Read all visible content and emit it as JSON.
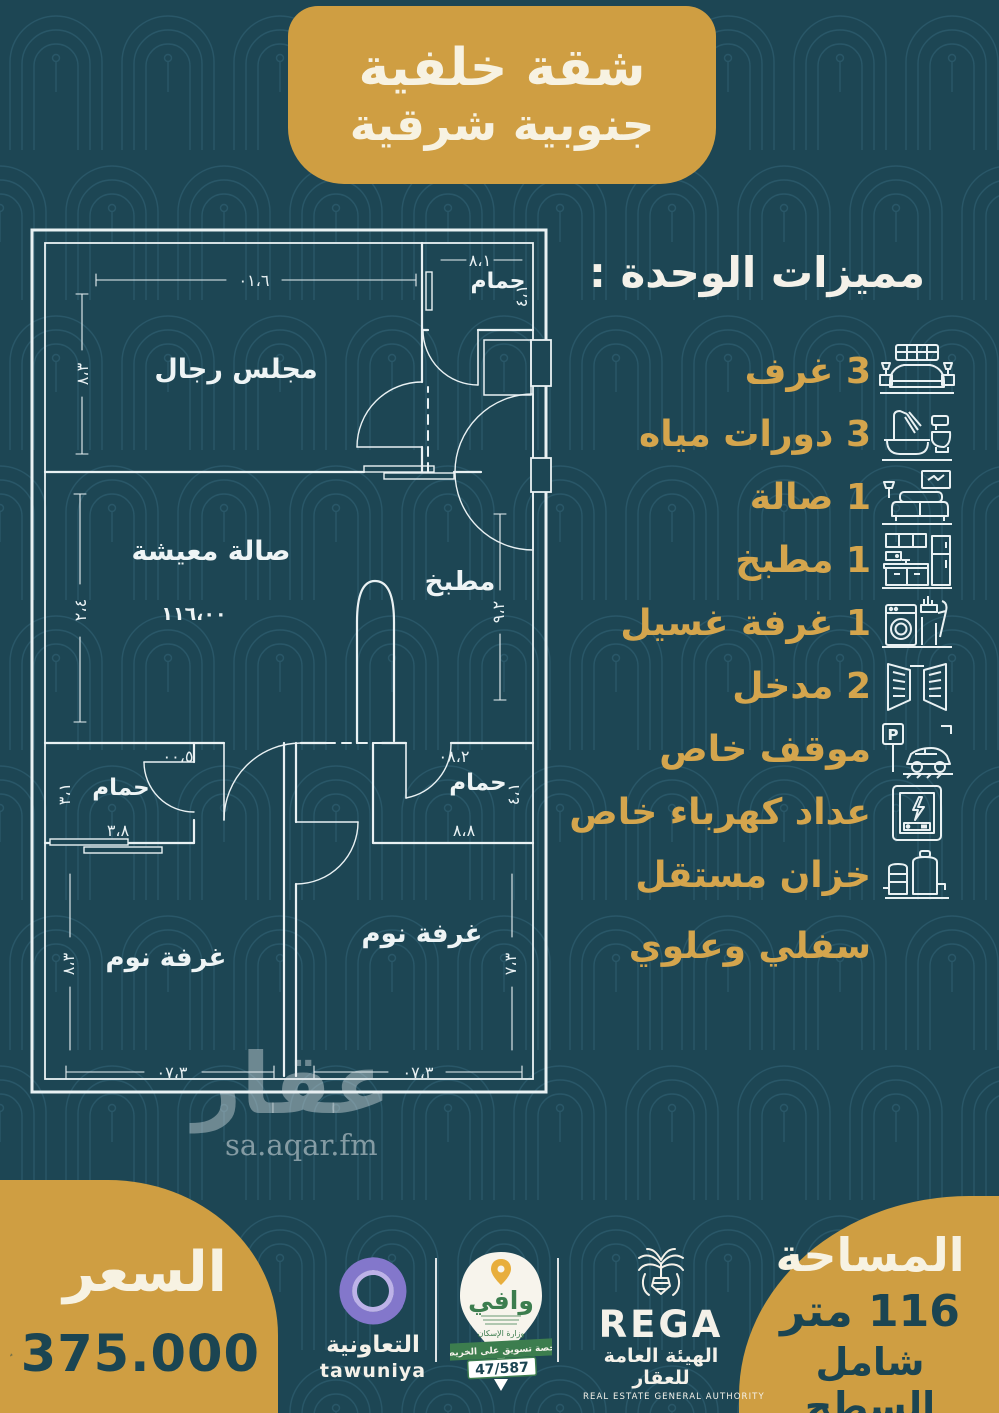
{
  "banner": {
    "line1": "شقة خلفية",
    "line2": "جنوبية شرقية"
  },
  "features": {
    "heading": "مميزات الوحدة :",
    "items": [
      {
        "label": "3 غرف",
        "icon": "bed-icon"
      },
      {
        "label": "3 دورات مياه",
        "icon": "bathtub-icon"
      },
      {
        "label": "1 صالة",
        "icon": "sofa-icon"
      },
      {
        "label": "1 مطبخ",
        "icon": "kitchen-icon"
      },
      {
        "label": "1 غرفة غسيل",
        "icon": "washing-machine-icon"
      },
      {
        "label": "2 مدخل",
        "icon": "double-door-icon"
      },
      {
        "label": "موقف خاص",
        "icon": "parking-icon"
      },
      {
        "label": "عداد كهرباء خاص",
        "icon": "electric-meter-icon"
      },
      {
        "label": "خزان مستقل",
        "icon": "water-tank-icon"
      },
      {
        "label": "سفلي وعلوي",
        "icon": ""
      }
    ]
  },
  "plan": {
    "rooms": {
      "majlis": "مجلس رجال",
      "bath_top": "حمام",
      "living": "صالة معيشة",
      "living_area": "١١٦،٠٠",
      "kitchen": "مطبخ",
      "bath_left": "حمام",
      "bath_right": "حمام",
      "bed_left": "غرفة نوم",
      "bed_right": "غرفة نوم"
    },
    "dims": {
      "majlis_w": "٠١،٦",
      "majlis_h": "٨،٣",
      "bath_top_w": "٨،١",
      "bath_top_h": "٤،١",
      "living_h": "٢،٤",
      "living_w": "٠٠،٥",
      "kitchen_w": "٠٨،٢",
      "kitchen_h": "٩،٢",
      "bath_left_w": "٣،٨",
      "bath_left_h": "٣،١",
      "bath_right_w": "٨،٨",
      "bath_right_h": "٤،١",
      "bed_left_w": "٠٧،٣",
      "bed_left_h": "٨،٣",
      "bed_right_w": "٠٧،٣",
      "bed_right_h": "٧،٣"
    }
  },
  "watermark": {
    "arabic": "عقار",
    "domain": "sa.aqar.fm"
  },
  "price": {
    "label": "السعر",
    "value": "375.000"
  },
  "area": {
    "label": "المساحة",
    "value": "116 متر",
    "note": "شامل السطح"
  },
  "logos": {
    "tawuniya": {
      "arabic": "التعاونية",
      "latin": "tawuniya"
    },
    "wafi": {
      "name": "وافي",
      "ministry": "وزارة الإسكان",
      "license_label": "رخصة تسويق على الخريطة",
      "license_number": "47/587"
    },
    "rega": {
      "latin": "REGA",
      "arabic": "الهيئة العامة للعقار",
      "english": "REAL ESTATE GENERAL AUTHORITY"
    }
  },
  "colors": {
    "background": "#1d4654",
    "gold": "#cf9e42",
    "cream": "#f7f2e2",
    "teal_text": "#1b4552",
    "plan_line": "#e9f1f3",
    "feature_gold": "#d4a54d",
    "tawuniya_purple": "#8377cb",
    "wafi_green": "#3c7d4e"
  }
}
